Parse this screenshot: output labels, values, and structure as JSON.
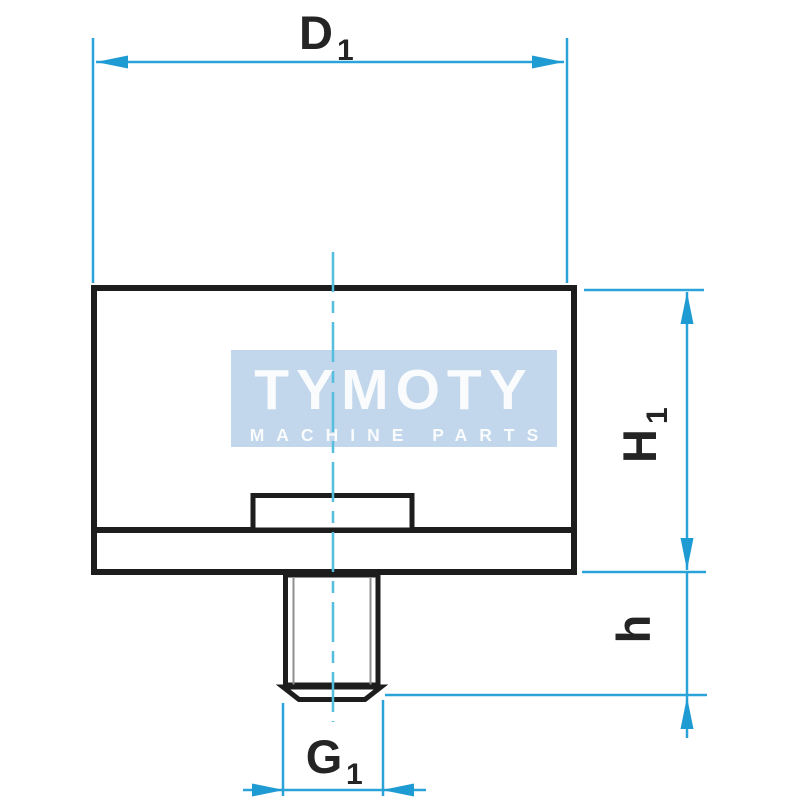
{
  "watermark": {
    "brand": "TYMOTY",
    "tagline": "MACHINE PARTS"
  },
  "dimension_labels": {
    "diameter": {
      "base": "D",
      "sub": "1"
    },
    "body_height": {
      "base": "H",
      "sub": "1"
    },
    "stud_length": {
      "base": "h",
      "sub": ""
    },
    "thread": {
      "base": "G",
      "sub": "1"
    }
  },
  "colors": {
    "dimension_line": "#2aa4d8",
    "arrowhead": "#1f9bd3",
    "center_line": "#55bede",
    "outline": "#1d1d1d",
    "hatch": "#9e9e9e",
    "watermark_bg": "#b3cde6",
    "watermark_text": "#ffffff",
    "label_text": "#242424",
    "background": "#ffffff"
  }
}
